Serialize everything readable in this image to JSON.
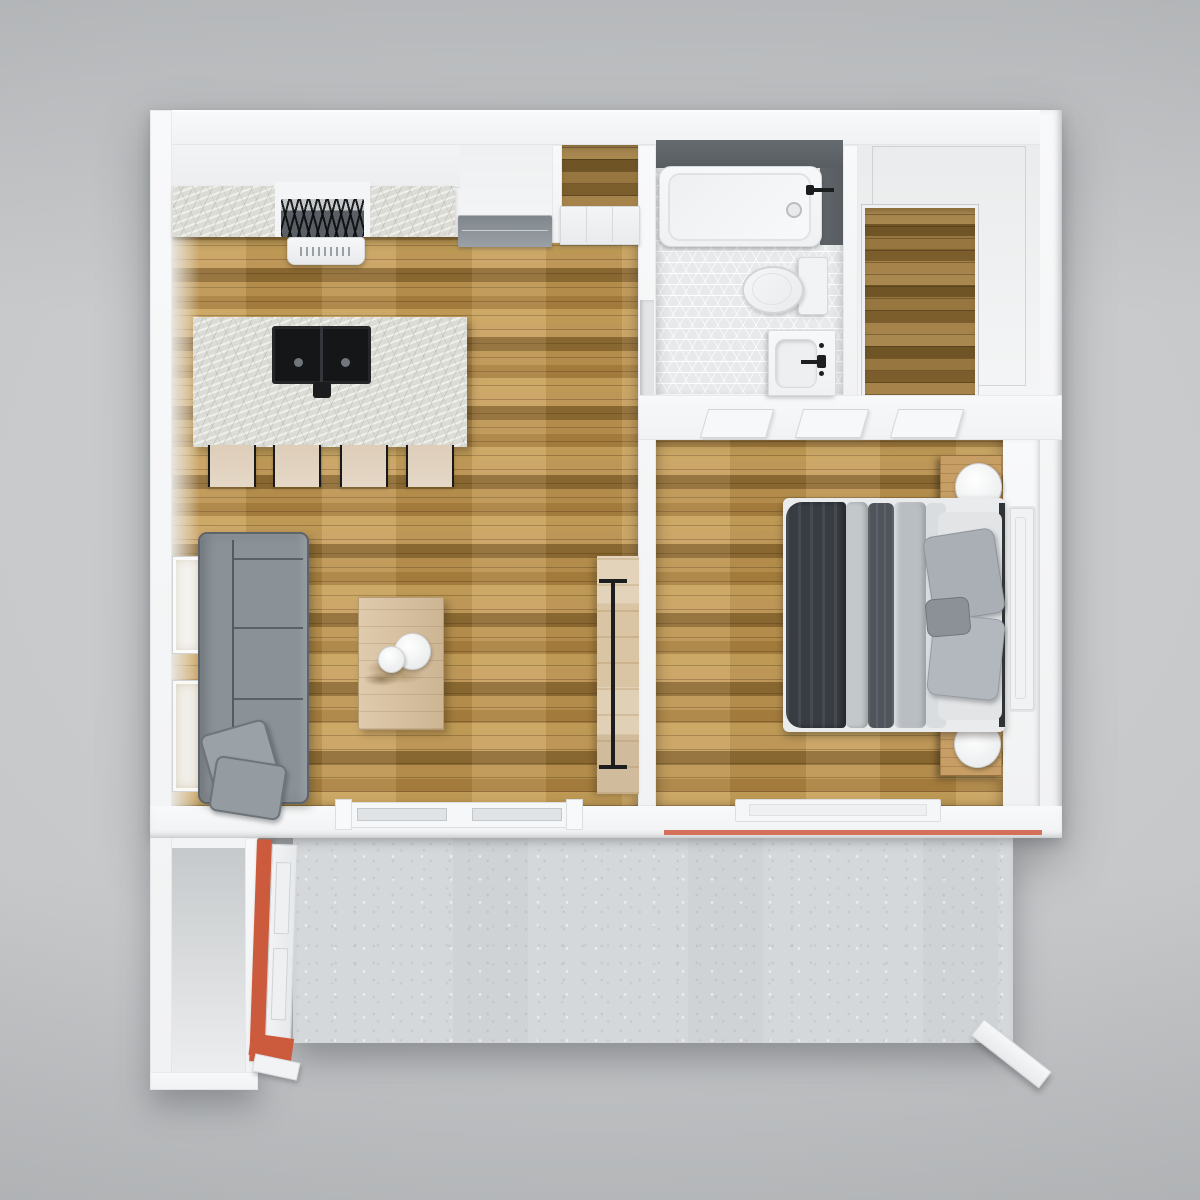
{
  "scene": {
    "title": "3D apartment floor plan, top-down render",
    "style": "photoreal dollhouse view on gray backdrop"
  },
  "palette": {
    "background": "#cdcfd1",
    "wall": "#f1f2f3",
    "woodBase": "#b3894a",
    "woodLight": "#c9a35c",
    "woodShade": "#8f6c33",
    "woodDarkBase": "#8f6f3d",
    "marbleBase": "#dcdcd7",
    "hexTile": "#e7e9ea",
    "tileDark": "#585d61",
    "concrete": "#d5d8da",
    "sofaGray": "#8a9197",
    "pillowGray": "#9aa1a7",
    "seatBeige": "#e6d8c7",
    "charcoal": "#383d43",
    "bedWhite": "#e9ebec",
    "nightstandWood": "#c79f66",
    "tableWood": "#d8bf9b",
    "barnDoorWood": "#d9c4a3",
    "doorOrange": "#cc5a3c",
    "accentRed": "#d4705a",
    "applianceGray": "#9aa0a5",
    "sinkBlack": "#141618",
    "fixtureWhite": "#eff1f2"
  },
  "rooms": {
    "kitchenLiving": "Kitchen & Living Room",
    "pantry": "Pantry Closet",
    "bathroom": "Bathroom",
    "closet": "Walk-in Closet",
    "bedroom": "Bedroom",
    "entry": "Entry Closet",
    "patio": "Concrete Patio"
  },
  "labels": {
    "range": "Gas range with hood",
    "fridge": "Refrigerator / appliance",
    "island": "Kitchen island with double sink",
    "stool": "Bar stool",
    "sofa": "Gray sectional sofa",
    "pillow": "Throw pillow",
    "coffeeTable": "Coffee table with dried-plant centerpiece",
    "barnDoor": "Sliding barn door",
    "wallArt": "Leaning wall art frames",
    "slidingDoor": "Sliding glass door",
    "tub": "Bathtub with dark tile surround",
    "toilet": "Toilet",
    "vanity": "Vanity sink",
    "bed": "Bed with charcoal throw and gray pillows",
    "nightstand": "Wood nightstand with round lamp",
    "windowRight": "Bedroom side window",
    "windowBottom": "Bedroom rear window",
    "doorTrim": "Open interior door",
    "frontDoor": "Orange front door (open)",
    "patioStep": "Patio step rail",
    "accentStripe": "Red exterior accent stripe"
  }
}
